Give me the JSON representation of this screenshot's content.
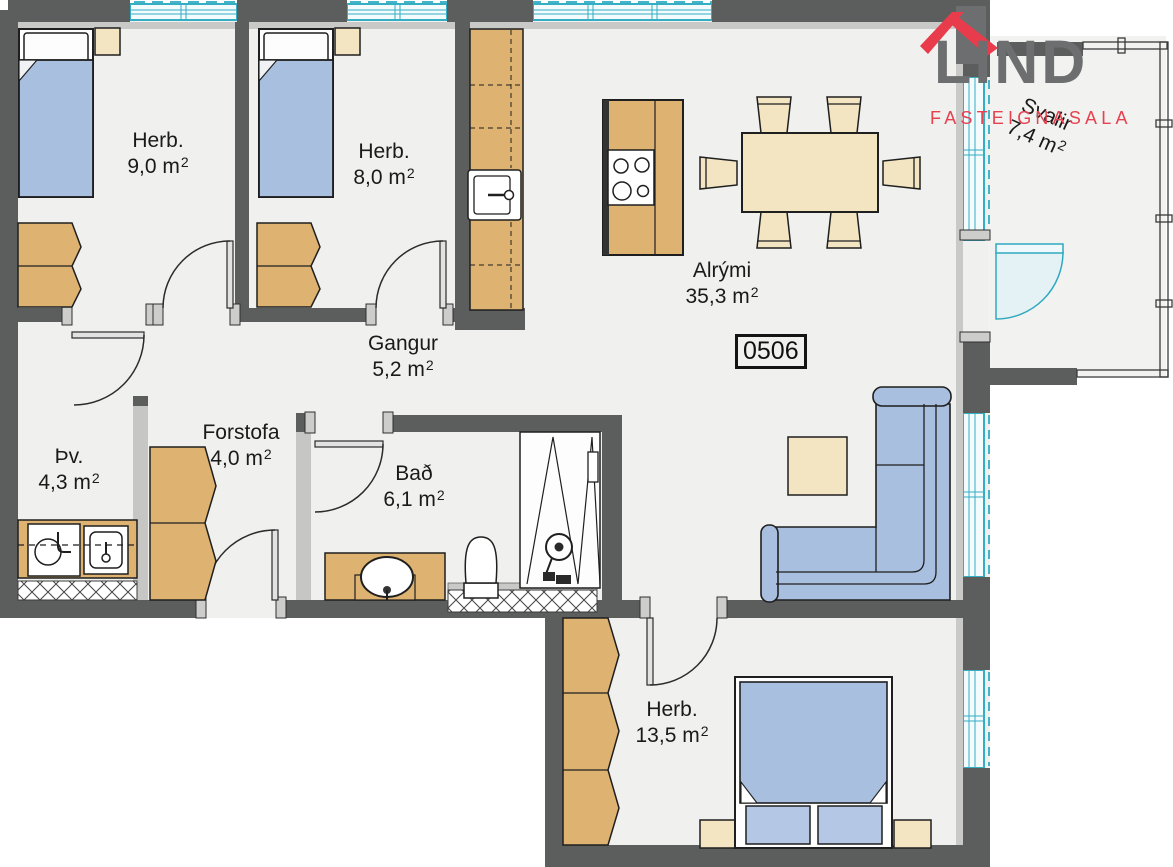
{
  "logo": {
    "brand": "LIND",
    "subtitle": "FASTEIGNASALA"
  },
  "unit": {
    "number": "0506"
  },
  "rooms": [
    {
      "id": "herb1",
      "name": "Herb.",
      "area": "9,0 m",
      "sup": "2"
    },
    {
      "id": "herb2",
      "name": "Herb.",
      "area": "8,0 m",
      "sup": "2"
    },
    {
      "id": "gangur",
      "name": "Gangur",
      "area": "5,2 m",
      "sup": "2"
    },
    {
      "id": "forstofa",
      "name": "Forstofa",
      "area": "4,0 m",
      "sup": "2"
    },
    {
      "id": "tv",
      "name": "Þv.",
      "area": "4,3 m",
      "sup": "2"
    },
    {
      "id": "bad",
      "name": "Bað",
      "area": "6,1 m",
      "sup": "2"
    },
    {
      "id": "alrymi",
      "name": "Alrými",
      "area": "35,3 m",
      "sup": "2"
    },
    {
      "id": "herb3",
      "name": "Herb.",
      "area": "13,5 m",
      "sup": "2"
    },
    {
      "id": "svalir",
      "name": "Svalir",
      "area": "7,4 m",
      "sup": "2"
    }
  ],
  "colors": {
    "brand_gray": "#6d6e70",
    "brand_red": "#e8404f",
    "wall": "#5c5d5d",
    "wall_light": "#c9c9c8",
    "floor": "#f0f0ee",
    "window_cyan": "#35adc3",
    "furniture_blue": "#a9bfdf",
    "furniture_tan": "#deb271",
    "furniture_beige": "#f3e5c2"
  }
}
